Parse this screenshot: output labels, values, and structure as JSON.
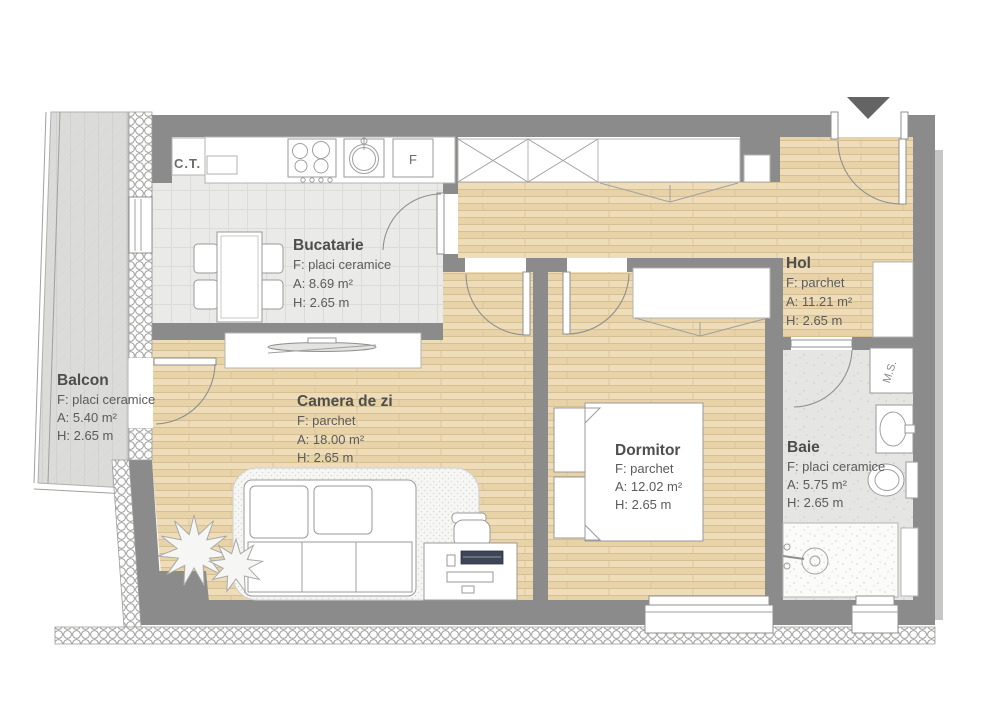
{
  "rooms": {
    "bucatarie": {
      "name": "Bucatarie",
      "floor": "F: placi ceramice",
      "area": "A: 8.69 m²",
      "height": "H: 2.65 m"
    },
    "hol": {
      "name": "Hol",
      "floor": "F: parchet",
      "area": "A: 11.21 m²",
      "height": "H: 2.65 m"
    },
    "camera_de_zi": {
      "name": "Camera de zi",
      "floor": "F: parchet",
      "area": "A: 18.00 m²",
      "height": "H: 2.65 m"
    },
    "dormitor": {
      "name": "Dormitor",
      "floor": "F: parchet",
      "area": "A: 12.02 m²",
      "height": "H: 2.65 m"
    },
    "baie": {
      "name": "Baie",
      "floor": "F: placi ceramice",
      "area": "A: 5.75 m²",
      "height": "H: 2.65 m"
    },
    "balcon": {
      "name": "Balcon",
      "floor": "F: placi ceramice",
      "area": "A: 5.40 m²",
      "height": "H: 2.65 m"
    }
  },
  "appliances": {
    "boiler": "C.T.",
    "fridge": "F",
    "washing_machine": "M.S."
  },
  "colors": {
    "wall": "#8b8b8b",
    "parquet": "#ecd9b3",
    "kitchen_tile": "#eaeae8",
    "bath_tile": "#e5e5e3",
    "balcony_floor": "#dbdbd9",
    "label_text": "#5b5b5b",
    "entrance_marker": "#646464"
  }
}
